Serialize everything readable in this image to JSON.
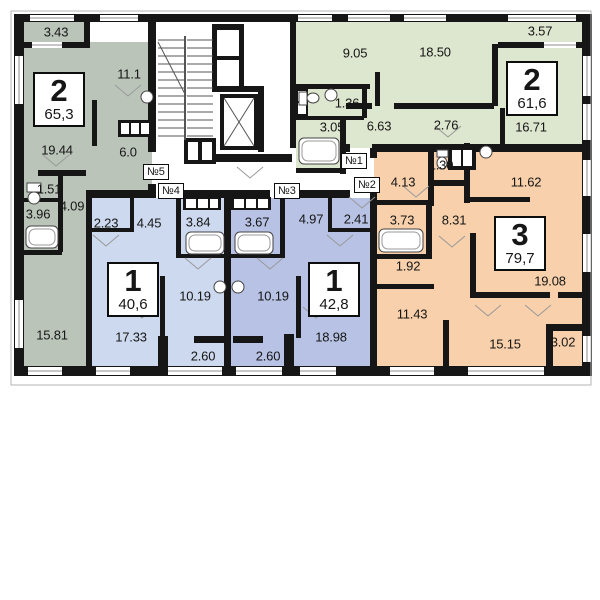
{
  "plan": {
    "wall_color": "#161616",
    "apartments": [
      {
        "number": "2",
        "total_area": "65,3",
        "entrance": "№5",
        "color": "#bac4b9",
        "rooms": [
          {
            "name": "balcony",
            "area": "3.43"
          },
          {
            "name": "kitchen",
            "area": "11.1"
          },
          {
            "name": "living-room",
            "area": "19.44"
          },
          {
            "name": "hall",
            "area": "6.0"
          },
          {
            "name": "wc",
            "area": "1.51"
          },
          {
            "name": "corridor",
            "area": "4.09"
          },
          {
            "name": "bathroom",
            "area": "3.96"
          },
          {
            "name": "bedroom",
            "area": "15.81"
          }
        ]
      },
      {
        "number": "2",
        "total_area": "61,6",
        "entrance": "№1",
        "color": "#dde6cf",
        "rooms": [
          {
            "name": "kitchen",
            "area": "9.05"
          },
          {
            "name": "living-room",
            "area": "18.50"
          },
          {
            "name": "balcony",
            "area": "3.57"
          },
          {
            "name": "wc",
            "area": "1.36"
          },
          {
            "name": "bathroom",
            "area": "3.05"
          },
          {
            "name": "hall",
            "area": "6.63"
          },
          {
            "name": "corridor",
            "area": "2.76"
          },
          {
            "name": "bedroom",
            "area": "16.71"
          }
        ]
      },
      {
        "number": "1",
        "total_area": "40,6",
        "entrance": "№4",
        "color": "#cdd9ee",
        "rooms": [
          {
            "name": "closet",
            "area": "2.23"
          },
          {
            "name": "hall",
            "area": "4.45"
          },
          {
            "name": "bathroom",
            "area": "3.84"
          },
          {
            "name": "kitchen",
            "area": "10.19"
          },
          {
            "name": "living-room",
            "area": "17.33"
          },
          {
            "name": "balcony",
            "area": "2.60"
          }
        ]
      },
      {
        "number": "1",
        "total_area": "42,8",
        "entrance": "№3",
        "color": "#b7c2e4",
        "rooms": [
          {
            "name": "hall",
            "area": "4.97"
          },
          {
            "name": "closet",
            "area": "2.41"
          },
          {
            "name": "bathroom",
            "area": "3.67"
          },
          {
            "name": "kitchen",
            "area": "10.19"
          },
          {
            "name": "living-room",
            "area": "18.98"
          },
          {
            "name": "balcony",
            "area": "2.60"
          }
        ]
      },
      {
        "number": "3",
        "total_area": "79,7",
        "entrance": "№2",
        "color": "#f8d0ab",
        "rooms": [
          {
            "name": "hall",
            "area": "4.13"
          },
          {
            "name": "wc",
            "area": "1.30"
          },
          {
            "name": "bedroom",
            "area": "11.62"
          },
          {
            "name": "bathroom",
            "area": "3.73"
          },
          {
            "name": "corridor",
            "area": "8.31"
          },
          {
            "name": "storage",
            "area": "1.92"
          },
          {
            "name": "kitchen",
            "area": "11.43"
          },
          {
            "name": "living-room",
            "area": "19.08"
          },
          {
            "name": "bedroom-2",
            "area": "15.15"
          },
          {
            "name": "balcony",
            "area": "3.02"
          }
        ]
      }
    ]
  }
}
